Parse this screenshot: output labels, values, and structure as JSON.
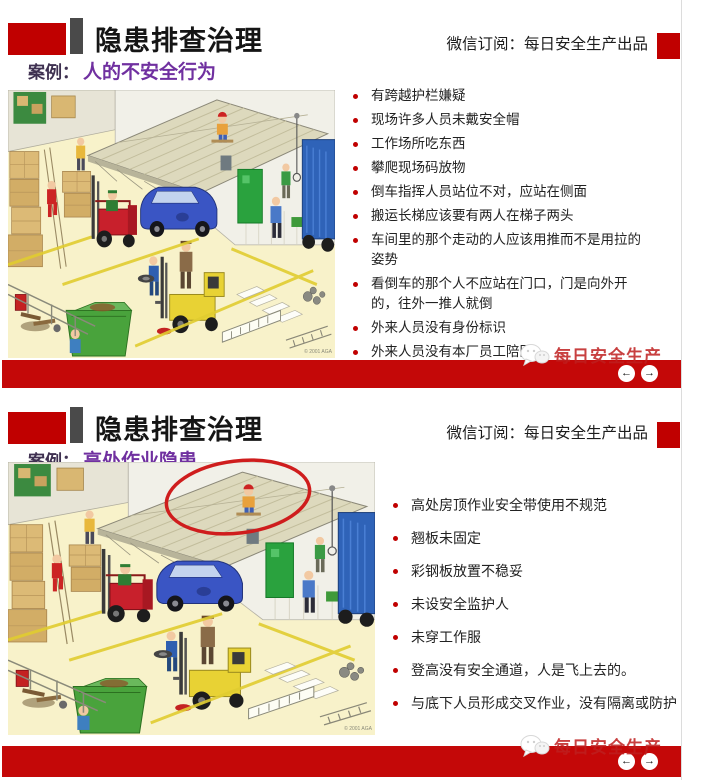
{
  "nav": {
    "prev": "←",
    "next": "→"
  },
  "watermark": {
    "label": "每日安全生产"
  },
  "colors": {
    "accent_red": "#c00000",
    "footer_red": "#c40808",
    "block_gray": "#4a4a4a",
    "case_purple": "#7030a0",
    "watermark_red": "#be1e1e"
  },
  "slides": [
    {
      "title": "隐患排查治理",
      "subscription": "微信订阅：每日安全生产出品",
      "case_label": "案例：",
      "case_title": "人的不安全行为",
      "bullets": [
        "有跨越护栏嫌疑",
        "现场许多人员未戴安全帽",
        "工作场所吃东西",
        "攀爬现场码放物",
        "倒车指挥人员站位不对，应站在侧面",
        "搬运长梯应该要有两人在梯子两头",
        "车间里的那个走动的人应该用推而不是用拉的姿势",
        "看倒车的那个人不应站在门口，门是向外开的，往外一推人就倒",
        "外来人员没有身份标识",
        "外来人员没有本厂员工陪同"
      ],
      "illustration_credit": "© 2001 AGA"
    },
    {
      "title": "隐患排查治理",
      "subscription": "微信订阅：每日安全生产出品",
      "case_label": "案例：",
      "case_title": "高处作业隐患",
      "bullets": [
        "高处房顶作业安全带使用不规范",
        "翘板未固定",
        "彩钢板放置不稳妥",
        "未设安全监护人",
        "未穿工作服",
        "登高没有安全通道，人是飞上去的。",
        "与底下人员形成交叉作业，没有隔离或防护"
      ],
      "illustration_credit": "© 2001 AGA"
    }
  ]
}
